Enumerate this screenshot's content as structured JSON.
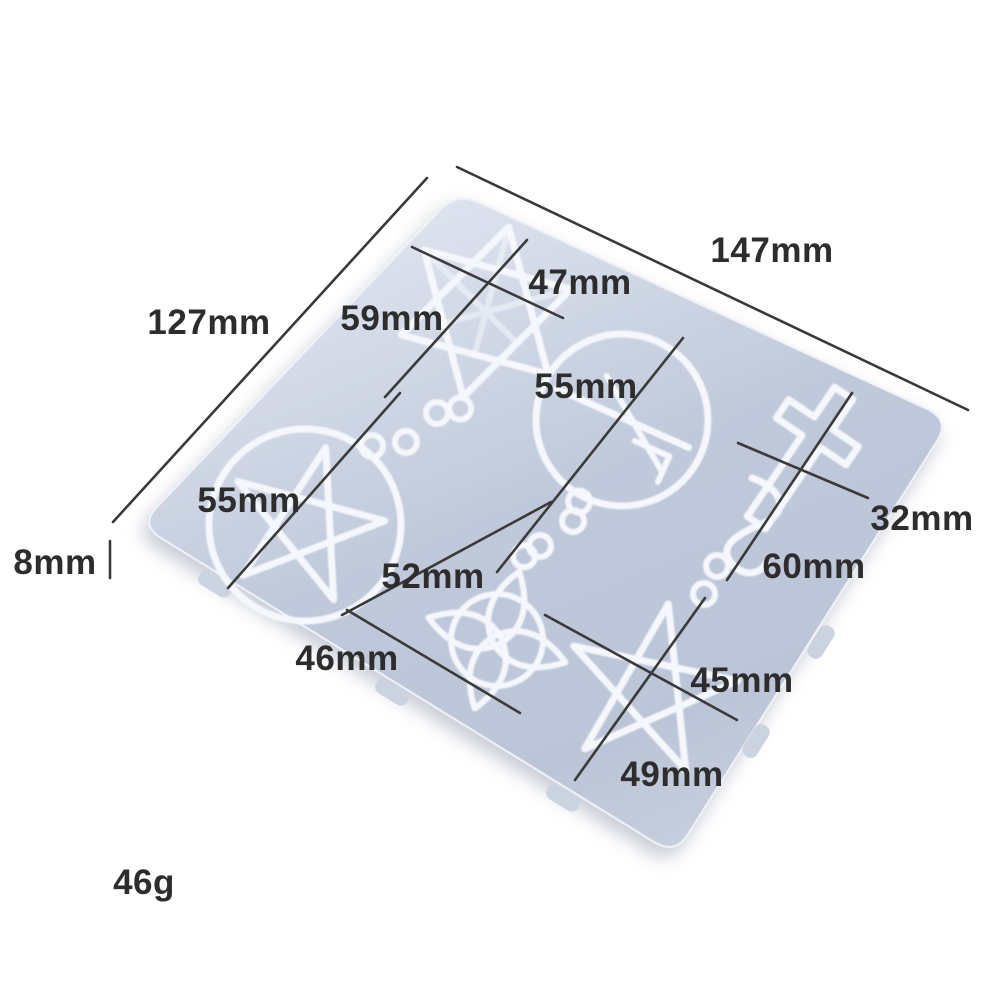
{
  "product": {
    "weight": "46g",
    "description": "silicone-pendant-mold"
  },
  "annotations": {
    "width": "147mm",
    "height": "127mm",
    "thickness": "8mm",
    "weight": "46g",
    "hexagram_width": "47mm",
    "hexagram_length": "59mm",
    "circle_diameter": "55mm",
    "pentacle_diameter": "55mm",
    "cross_length": "60mm",
    "cross_width": "32mm",
    "knot_length": "52mm",
    "knot_width": "46mm",
    "star_width": "45mm",
    "star_length": "49mm"
  },
  "colors": {
    "background": "#ffffff",
    "mold_fill": "#c4cbda",
    "mold_fill_light": "#dfe4ef",
    "cavity_outline": "#f4f7fc",
    "dimension_line": "#3a3a3a",
    "text": "#2d2d2d"
  }
}
